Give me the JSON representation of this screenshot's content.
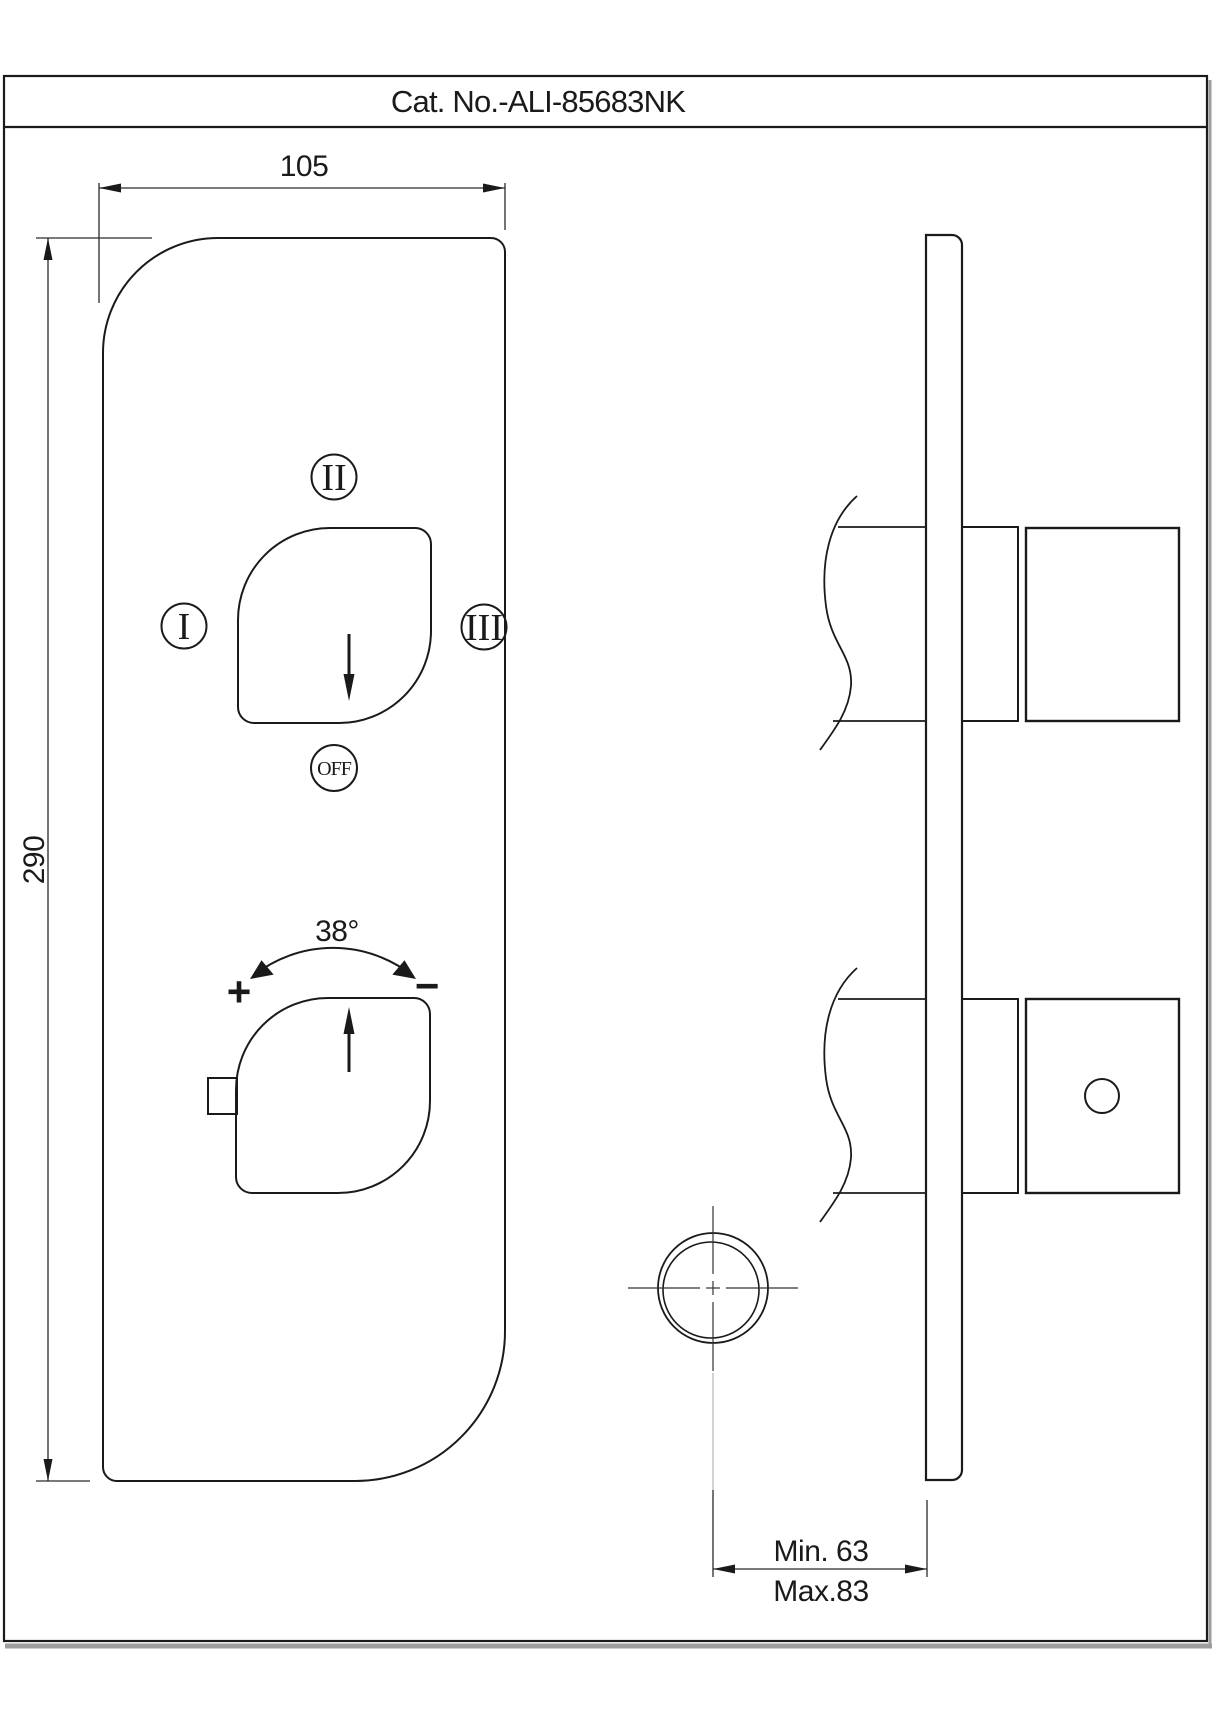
{
  "title": "Cat. No.-ALI-85683NK",
  "front_view": {
    "dim_width": "105",
    "dim_height": "290",
    "diverter": {
      "pos_top": "II",
      "pos_left": "I",
      "pos_right": "III",
      "off_label": "OFF"
    },
    "temperature": {
      "angle": "38°",
      "plus": "+",
      "minus": "−"
    }
  },
  "side_view": {
    "depth_min": "Min. 63",
    "depth_max": "Max.83"
  },
  "colors": {
    "line": "#1a1a1a",
    "dim_line": "#2a2a2a",
    "shadow": "#9e9e9e",
    "background": "#ffffff"
  }
}
